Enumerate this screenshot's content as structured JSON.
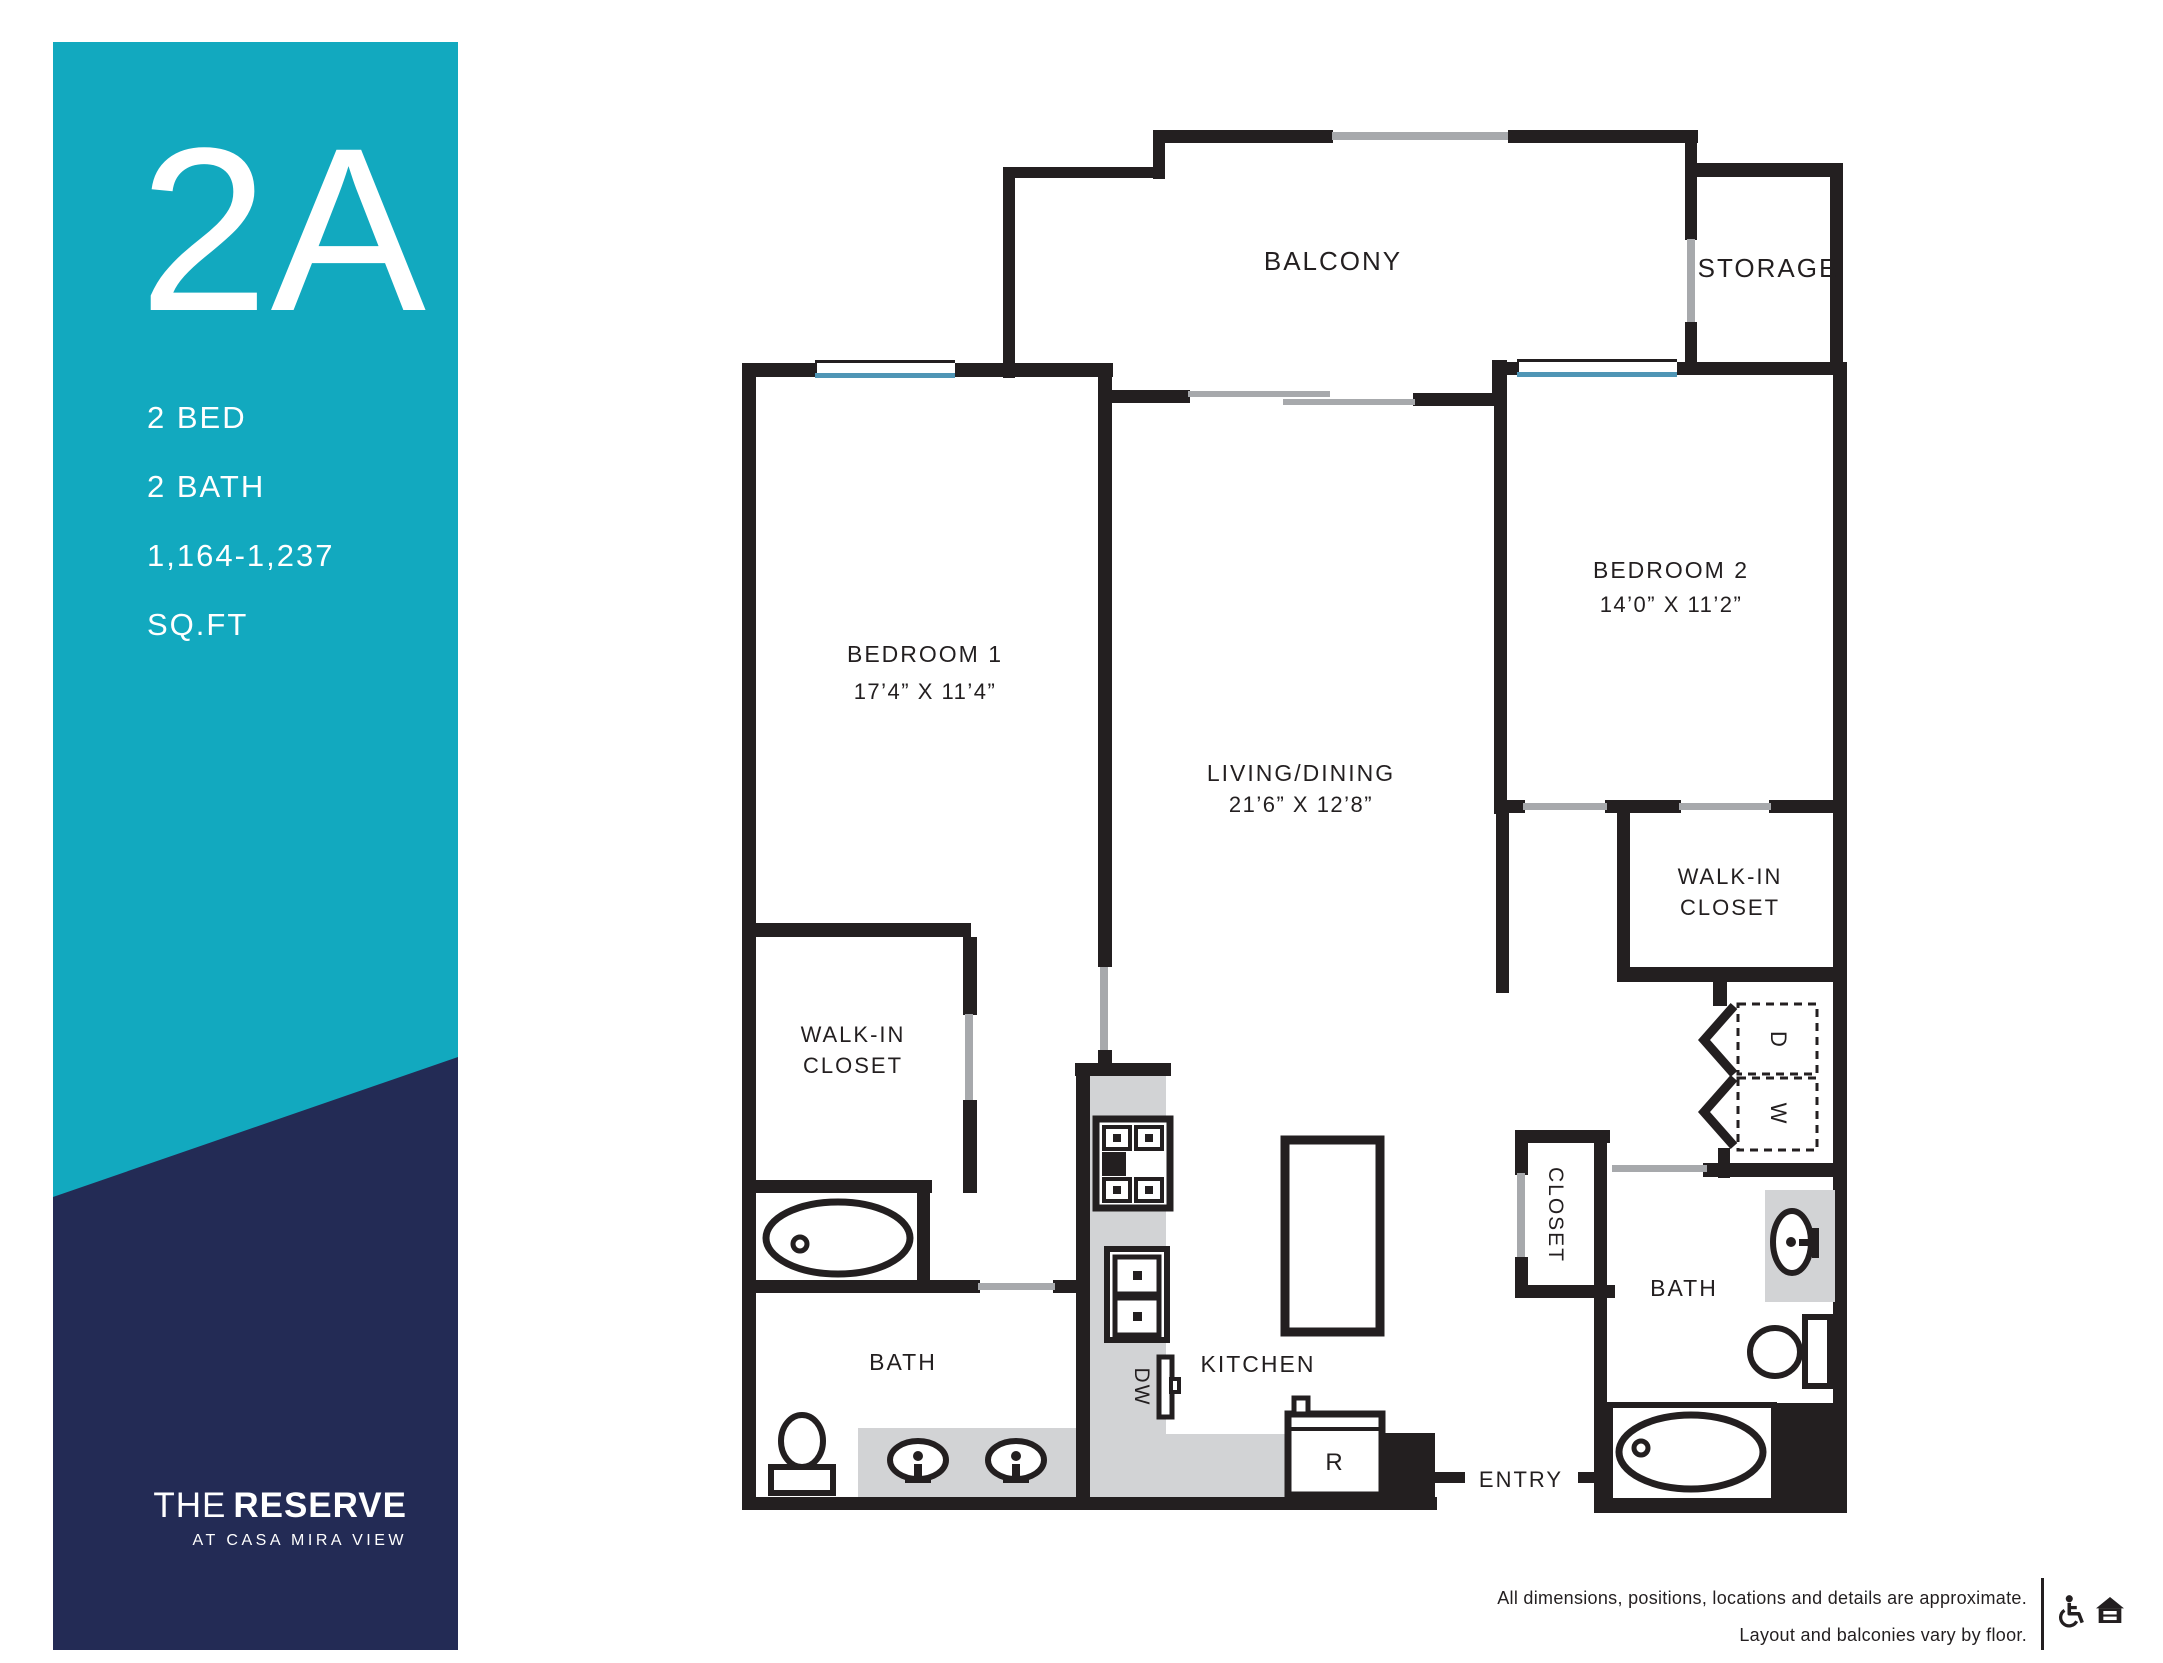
{
  "sidebar": {
    "teal": "#12a9bf",
    "navy": "#232b55",
    "unit": "2A",
    "specs": [
      "2 BED",
      "2 BATH",
      "1,164-1,237",
      "SQ.FT"
    ],
    "brand": {
      "the": "THE",
      "reserve": "RESERVE",
      "tagline": "AT CASA MIRA VIEW"
    }
  },
  "plan": {
    "wall_color": "#231f20",
    "door_color": "#a7a9ac",
    "window_color": "#4f95b5",
    "counter_color": "#d2d3d5",
    "rooms": {
      "balcony": "BALCONY",
      "storage": "STORAGE",
      "bedroom1": {
        "name": "BEDROOM 1",
        "dims": "17’4” X 11’4”"
      },
      "bedroom2": {
        "name": "BEDROOM 2",
        "dims": "14’0” X 11’2”"
      },
      "living": {
        "name": "LIVING/DINING",
        "dims": "21’6” X 12’8”"
      },
      "wic1": {
        "line1": "WALK-IN",
        "line2": "CLOSET"
      },
      "wic2": {
        "line1": "WALK-IN",
        "line2": "CLOSET"
      },
      "bath1": "BATH",
      "bath2": "BATH",
      "kitchen": "KITCHEN",
      "closet": "CLOSET",
      "entry": "ENTRY",
      "dishwasher": "DW",
      "refrigerator": "R",
      "dryer": "D",
      "washer": "W"
    }
  },
  "footer": {
    "line1": "All dimensions, positions, locations and details are approximate.",
    "line2": "Layout and balconies vary by floor."
  }
}
